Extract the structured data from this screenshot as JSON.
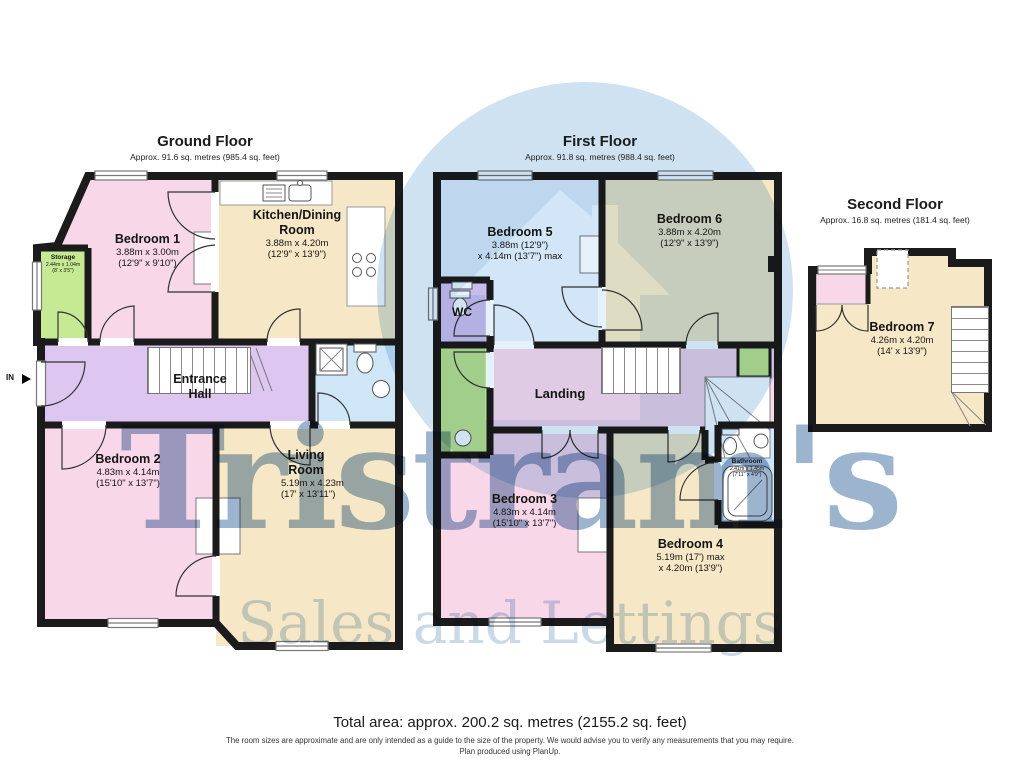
{
  "watermark": {
    "brand": "Tristram's",
    "tagline": "Sales and Lettings"
  },
  "floors": {
    "ground": {
      "title": "Ground Floor",
      "subtitle": "Approx. 91.6 sq. metres (985.4 sq. feet)"
    },
    "first": {
      "title": "First Floor",
      "subtitle": "Approx. 91.8 sq. metres (988.4 sq. feet)"
    },
    "second": {
      "title": "Second Floor",
      "subtitle": "Approx. 16.8 sq. metres (181.4 sq. feet)"
    }
  },
  "rooms": {
    "bedroom1": {
      "name": "Bedroom 1",
      "dims1": "3.88m x 3.00m",
      "dims2": "(12'9\" x 9'10\")"
    },
    "kitchen": {
      "name": "Kitchen/Dining Room",
      "dims1": "3.88m x 4.20m",
      "dims2": "(12'9\" x 13'9\")"
    },
    "storage": {
      "name": "Storage",
      "dims1": "2.44m x 1.04m",
      "dims2": "(8' x 3'5\")"
    },
    "entrance_hall": {
      "name": "Entrance Hall"
    },
    "bedroom2": {
      "name": "Bedroom 2",
      "dims1": "4.83m x 4.14m",
      "dims2": "(15'10\" x 13'7\")"
    },
    "living": {
      "name": "Living Room",
      "dims1": "5.19m x 4.23m",
      "dims2": "(17' x 13'11\")"
    },
    "bedroom5": {
      "name": "Bedroom 5",
      "dims1": "3.88m (12'9\")",
      "dims2": "x 4.14m (13'7\") max"
    },
    "bedroom6": {
      "name": "Bedroom 6",
      "dims1": "3.88m x 4.20m",
      "dims2": "(12'9\" x 13'9\")"
    },
    "wc": {
      "name": "WC"
    },
    "landing": {
      "name": "Landing"
    },
    "bedroom3": {
      "name": "Bedroom 3",
      "dims1": "4.83m x 4.14m",
      "dims2": "(15'10\" x 13'7\")"
    },
    "bedroom4": {
      "name": "Bedroom 4",
      "dims1": "5.19m (17') max",
      "dims2": "x 4.20m (13'9\")"
    },
    "bathroom": {
      "name": "Bathroom",
      "dims1": "2.41m x 1.45m",
      "dims2": "(7'11\" x 4'9\")"
    },
    "bedroom7": {
      "name": "Bedroom 7",
      "dims1": "4.26m x 4.20m",
      "dims2": "(14' x 13'9\")"
    }
  },
  "entrance": {
    "in_label": "IN"
  },
  "footer": {
    "total": "Total area: approx. 200.2 sq. metres (2155.2 sq. feet)",
    "disclaimer": "The room sizes are approximate and are only intended as a guide to the size of the property. We would advise you to verify any measurements that you may require.",
    "produced": "Plan produced using PlanUp."
  },
  "colors": {
    "bedroom_pink": "#f8d7e8",
    "cream": "#f6e8c6",
    "hall_lavender": "#ddc7f0",
    "storage_green": "#c6ea93",
    "bath_blue": "#cfe6f7",
    "bed5_blue": "#eaf3fb",
    "wall": "#1b1b1b",
    "watermark_blue": "#9db4cf"
  }
}
